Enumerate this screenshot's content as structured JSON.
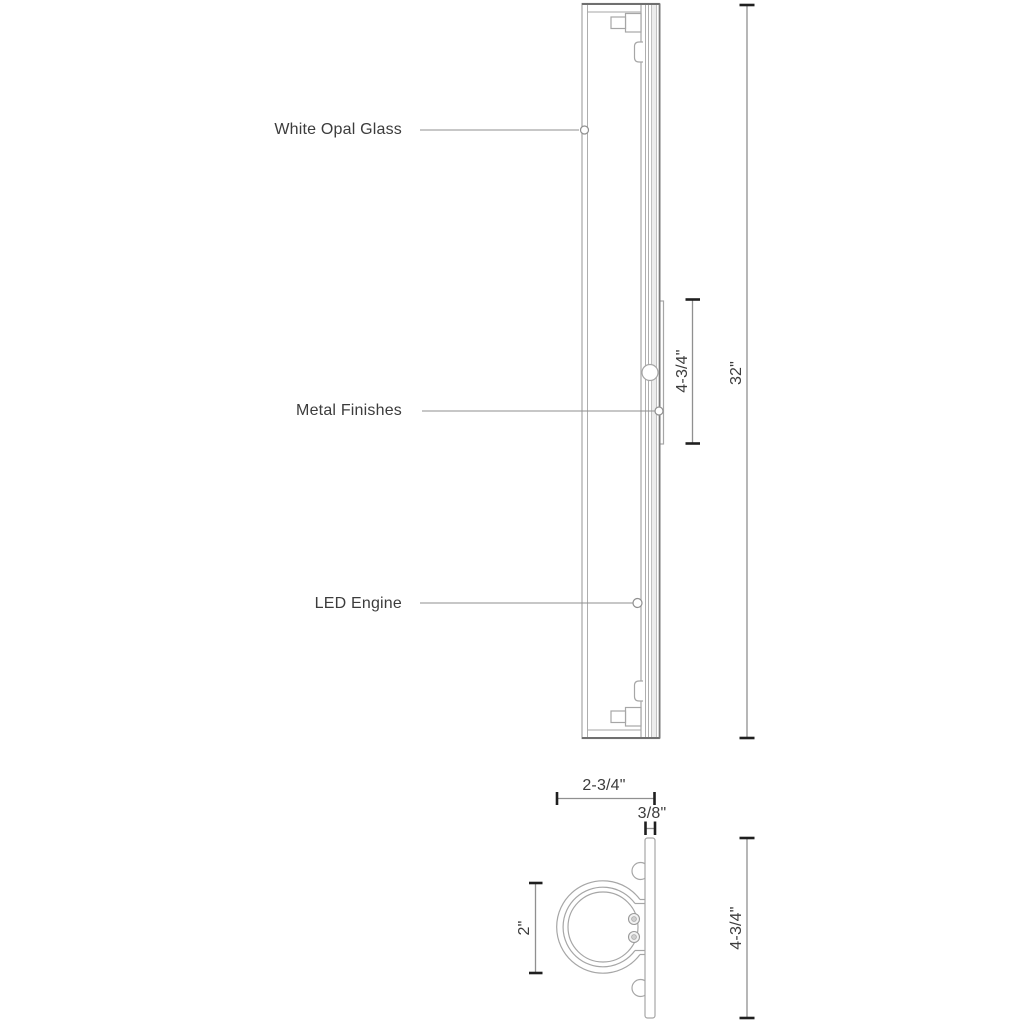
{
  "callouts": [
    {
      "label": "White Opal Glass"
    },
    {
      "label": "Metal Finishes"
    },
    {
      "label": "LED Engine"
    }
  ],
  "side_view": {
    "overall_height": "32\"",
    "backplate_height": "4-3/4\""
  },
  "end_view": {
    "depth": "2-3/4\"",
    "plate_thickness": "3/8\"",
    "glass_diameter": "2\"",
    "plate_height": "4-3/4\""
  },
  "colors": {
    "line-color": "#a6a6a6",
    "dim-color": "#909090",
    "tick-color": "#1f1f1f",
    "text-color": "#3c3c3c",
    "background": "#ffffff"
  }
}
